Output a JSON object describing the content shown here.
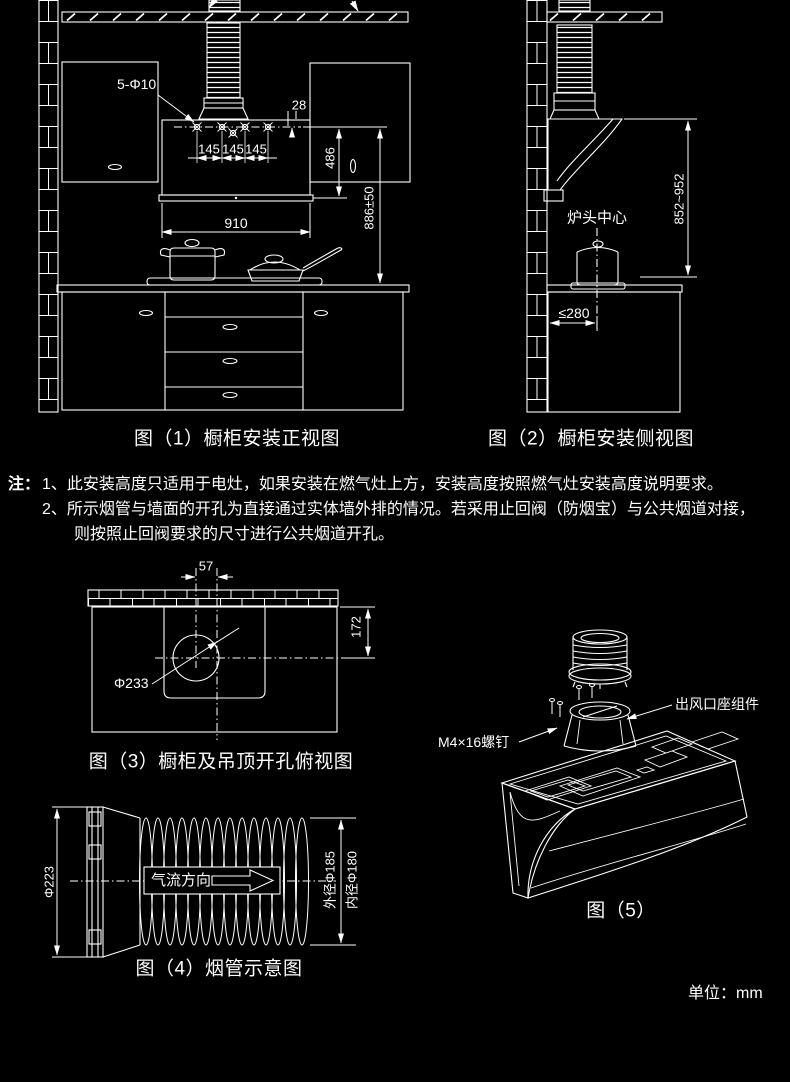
{
  "page": {
    "background": "#000000",
    "line_color": "#ffffff",
    "text_color": "#ffffff",
    "unit_label": "单位：mm"
  },
  "figure1": {
    "caption": "图（1）橱柜安装正视图",
    "hole_label": "5-Φ10",
    "ceiling_clearance": "≥120",
    "dim_28": "28",
    "dim_145_1": "145",
    "dim_145_2": "145",
    "dim_145_3": "145",
    "dim_910": "910",
    "dim_486": "486",
    "dim_886": "886±50"
  },
  "figure2": {
    "caption": "图（2）橱柜安装侧视图",
    "stove_center_label": "炉头中心",
    "dim_height_range": "852~952",
    "dim_wall_distance": "≤280"
  },
  "notes": {
    "prefix": "注：",
    "line1": "1、此安装高度只适用于电灶，如果安装在燃气灶上方，安装高度按照燃气灶安装高度说明要求。",
    "line2": "2、所示烟管与墙面的开孔为直接通过实体墙外排的情况。若采用止回阀（防烟宝）与公共烟道对接，",
    "line3": "则按照止回阀要求的尺寸进行公共烟道开孔。"
  },
  "figure3": {
    "caption": "图（3）橱柜及吊顶开孔俯视图",
    "dim_57": "57",
    "dim_172": "172",
    "hole_diameter": "Φ233"
  },
  "figure4": {
    "caption": "图（4）烟管示意图",
    "airflow_label": "气流方向",
    "dim_flange": "Φ223",
    "dim_outer": "外径Φ185",
    "dim_inner": "内径Φ180"
  },
  "figure5": {
    "caption": "图（5）",
    "outlet_label": "出风口座组件",
    "screw_label": "M4×16螺钉"
  }
}
